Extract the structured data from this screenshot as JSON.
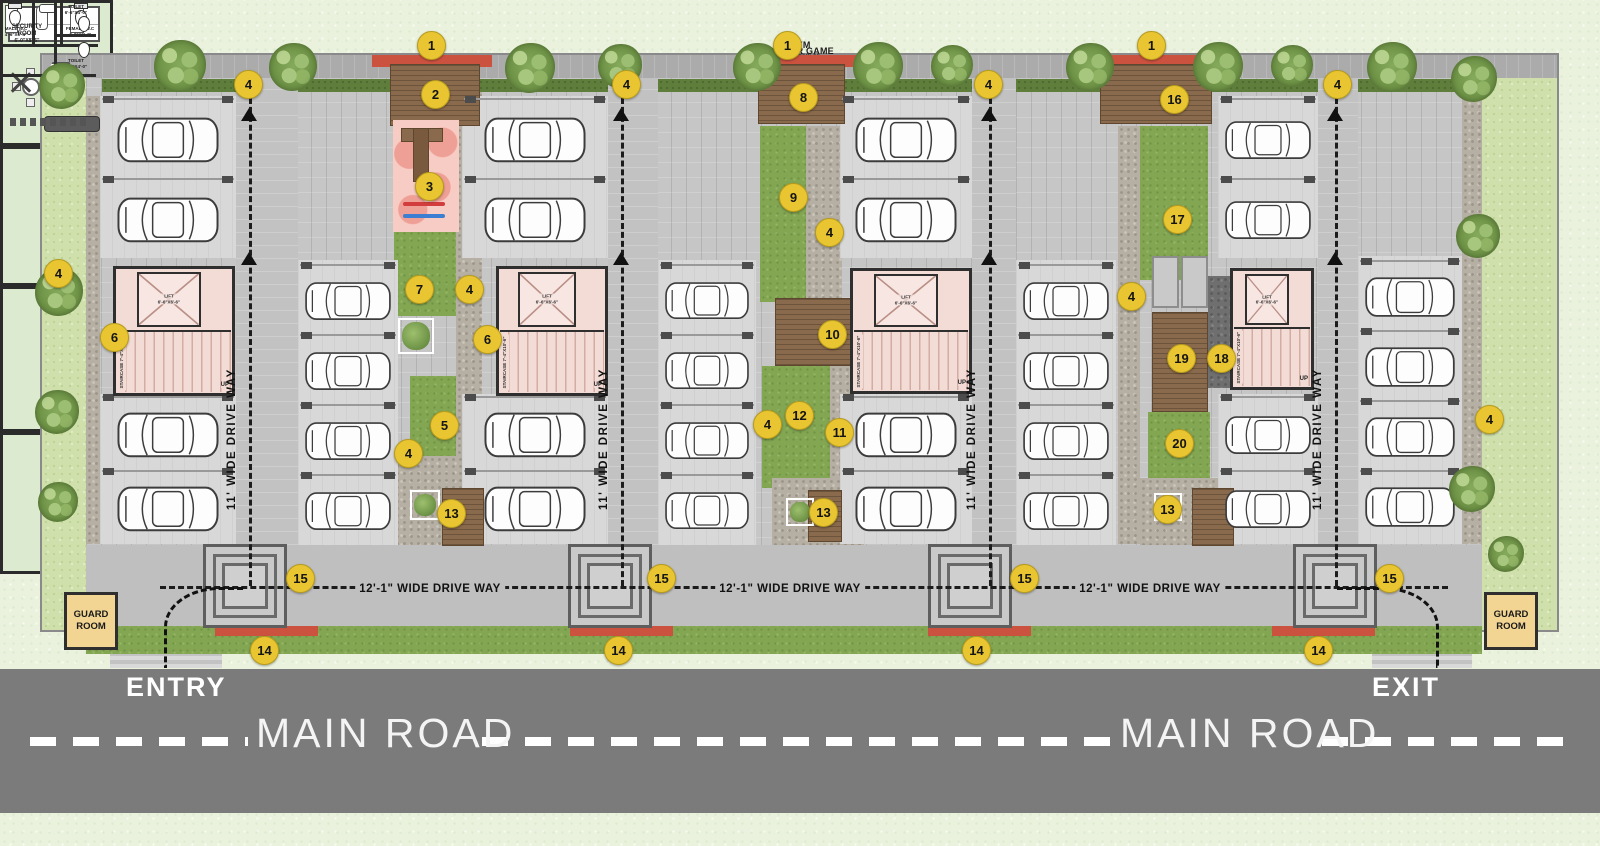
{
  "colors": {
    "marker_yellow": "#e8c531",
    "road_gray": "#7b7b7b",
    "deck_brown": "#8a6a4c",
    "lawn_green": "#83a653",
    "room_green": "#dcead0",
    "core_pink": "#f3dcd6",
    "red_accent": "#cc5240",
    "guard_tan": "#f2d593"
  },
  "labels": {
    "drive_vertical": "11' WIDE DRIVE WAY",
    "drive_horizontal": "12'-1\" WIDE DRIVE WAY",
    "entry": "ENTRY",
    "exit": "EXIT",
    "main_road": "MAIN ROAD",
    "up": "UP"
  },
  "rooms": {
    "indoor_game": {
      "name": "INDOOR GAME",
      "dim": "12'-4\"X18'-1\""
    },
    "gym": {
      "name": "GYM",
      "dim": "12'-4\"X18'-1\""
    },
    "community_hall": {
      "name": "COMMUNITY HALL",
      "dim": "12'-4\"X13'-0\""
    },
    "male_wc": {
      "name": "MALE W.C",
      "dim": "4'-6\"X6'-4\""
    },
    "female_wc": {
      "name": "FEMALE W.C",
      "dim": "4'-0\"X6'-4\""
    },
    "security_room": {
      "name": "SECURITY ROOM",
      "dim": "6'-0\"X8'-5\""
    },
    "toilet": {
      "name": "TOILET",
      "dim": "6'-6\"X4'-0\""
    },
    "society_office": {
      "name": "SOCITY OFFICE",
      "dim": "12'-0\"X9'-0\""
    },
    "lift": {
      "name": "LIFT",
      "dim": "6'-6\"X6'-6\""
    },
    "staircase": {
      "name": "STAIRCASE",
      "dim": "7'-4\"X10'-6\""
    },
    "guard_room": {
      "name": "GUARD ROOM"
    }
  },
  "markers": [
    {
      "n": "1",
      "x": 430,
      "y": 44
    },
    {
      "n": "1",
      "x": 786,
      "y": 44
    },
    {
      "n": "1",
      "x": 1150,
      "y": 44
    },
    {
      "n": "2",
      "x": 434,
      "y": 93
    },
    {
      "n": "3",
      "x": 428,
      "y": 185
    },
    {
      "n": "4",
      "x": 247,
      "y": 83
    },
    {
      "n": "4",
      "x": 625,
      "y": 83
    },
    {
      "n": "4",
      "x": 987,
      "y": 83
    },
    {
      "n": "4",
      "x": 1336,
      "y": 83
    },
    {
      "n": "4",
      "x": 57,
      "y": 272
    },
    {
      "n": "4",
      "x": 468,
      "y": 288
    },
    {
      "n": "4",
      "x": 828,
      "y": 231
    },
    {
      "n": "4",
      "x": 407,
      "y": 452
    },
    {
      "n": "4",
      "x": 766,
      "y": 423
    },
    {
      "n": "4",
      "x": 1130,
      "y": 295
    },
    {
      "n": "4",
      "x": 1488,
      "y": 418
    },
    {
      "n": "5",
      "x": 443,
      "y": 424
    },
    {
      "n": "6",
      "x": 113,
      "y": 336
    },
    {
      "n": "6",
      "x": 486,
      "y": 338
    },
    {
      "n": "7",
      "x": 418,
      "y": 288
    },
    {
      "n": "8",
      "x": 802,
      "y": 96
    },
    {
      "n": "9",
      "x": 792,
      "y": 196
    },
    {
      "n": "10",
      "x": 831,
      "y": 333
    },
    {
      "n": "11",
      "x": 838,
      "y": 431
    },
    {
      "n": "12",
      "x": 798,
      "y": 414
    },
    {
      "n": "13",
      "x": 450,
      "y": 512
    },
    {
      "n": "13",
      "x": 822,
      "y": 511
    },
    {
      "n": "13",
      "x": 1166,
      "y": 508
    },
    {
      "n": "14",
      "x": 263,
      "y": 649
    },
    {
      "n": "14",
      "x": 617,
      "y": 649
    },
    {
      "n": "14",
      "x": 975,
      "y": 649
    },
    {
      "n": "14",
      "x": 1317,
      "y": 649
    },
    {
      "n": "15",
      "x": 299,
      "y": 577
    },
    {
      "n": "15",
      "x": 660,
      "y": 577
    },
    {
      "n": "15",
      "x": 1023,
      "y": 577
    },
    {
      "n": "15",
      "x": 1388,
      "y": 577
    },
    {
      "n": "16",
      "x": 1173,
      "y": 98
    },
    {
      "n": "17",
      "x": 1176,
      "y": 218
    },
    {
      "n": "18",
      "x": 1220,
      "y": 357
    },
    {
      "n": "19",
      "x": 1180,
      "y": 357
    },
    {
      "n": "20",
      "x": 1178,
      "y": 442
    }
  ]
}
